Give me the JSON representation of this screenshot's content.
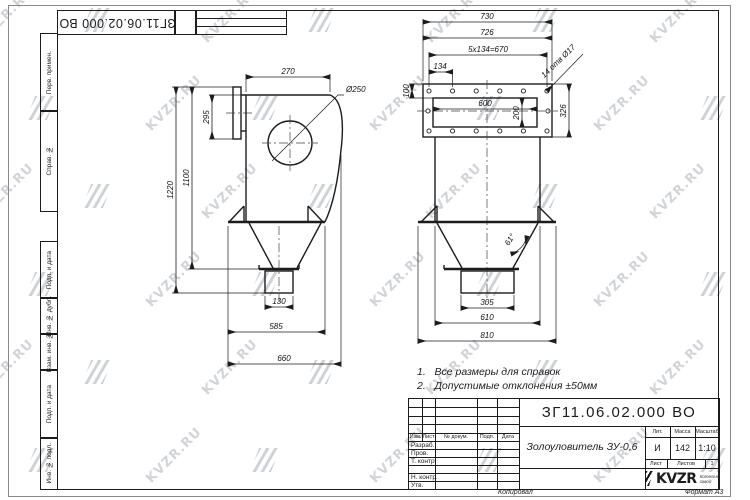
{
  "watermark": {
    "text": "KVZR.RU"
  },
  "margin": {
    "labels": [
      "Перв. примен.",
      "Справ. №",
      "Подп. и дата",
      "Инв. № дубл.",
      "Взам. инв. №",
      "Подп. и дата",
      "Инв. № подл."
    ]
  },
  "top_stamp": {
    "doc_number": "ЗГ11.06.02.000 ВО"
  },
  "notes": {
    "items": [
      {
        "num": "1.",
        "text": "Все размеры для справок"
      },
      {
        "num": "2.",
        "text": "Допустимые отклонения ±50мм"
      }
    ]
  },
  "title_block": {
    "doc_number": "ЗГ11.06.02.000 ВО",
    "product_name": "Золоуловитель ЗУ-0,6",
    "headers": {
      "izm": "Изм.",
      "list": "Лист",
      "doc": "№ докум.",
      "podp": "Подп.",
      "data": "Дата"
    },
    "rows": {
      "razrab": "Разраб.",
      "prov": "Пров.",
      "tkontr": "Т. контр.",
      "nkontr": "Н. контр.",
      "utv": "Утв."
    },
    "lit_header": "Лит.",
    "mass_header": "Масса",
    "scale_header": "Масштаб",
    "lit": "И",
    "mass": "142",
    "scale": "1:10",
    "sheet_header": "Лист",
    "sheets_header": "Листов",
    "sheets_value": "1",
    "company": "KVZR",
    "company_sub1": "Котельный",
    "company_sub2": "завод",
    "copied": "Копировал",
    "format": "Формат А3"
  },
  "views": {
    "front": {
      "dims": {
        "d270": "270",
        "d250": "Ø250",
        "d295": "295",
        "d1220": "1220",
        "d1100": "1100",
        "d130": "130",
        "d585": "585",
        "d660": "660"
      }
    },
    "side": {
      "dims": {
        "d730": "730",
        "d726": "726",
        "d670": "5x134=670",
        "d134": "134",
        "holes": "14 отв Ø17",
        "d100": "100",
        "d600": "600",
        "d200": "200",
        "d326": "326",
        "d61": "61°",
        "d305": "305",
        "d610": "610",
        "d810": "810"
      }
    }
  }
}
